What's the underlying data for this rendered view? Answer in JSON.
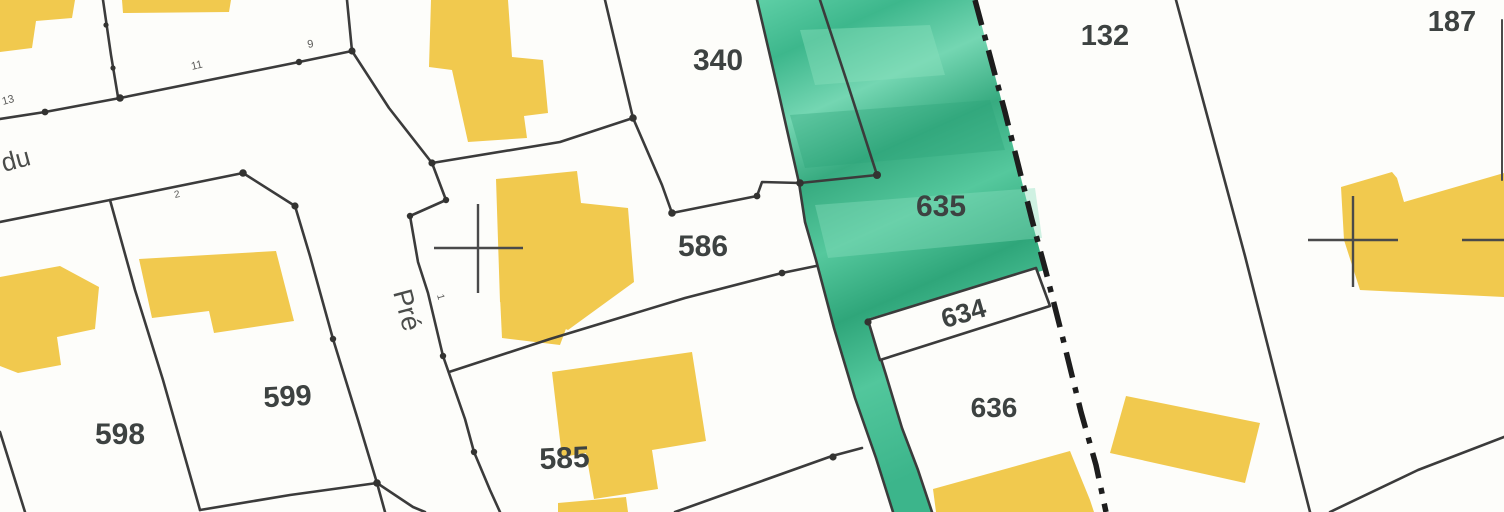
{
  "map": {
    "kind": "cadastral-parcel-map",
    "street": {
      "word_du": "du",
      "word_pre": "Pré"
    },
    "highlighted_parcel": "635",
    "parcels": [
      {
        "number": "340"
      },
      {
        "number": "586"
      },
      {
        "number": "635"
      },
      {
        "number": "634"
      },
      {
        "number": "636"
      },
      {
        "number": "132"
      },
      {
        "number": "187"
      },
      {
        "number": "598"
      },
      {
        "number": "599"
      },
      {
        "number": "585"
      }
    ],
    "survey_marks": [
      {
        "value": "13"
      },
      {
        "value": "11"
      },
      {
        "value": "9"
      },
      {
        "value": "2"
      },
      {
        "value": "1"
      }
    ],
    "colors": {
      "background": "#fdfdfa",
      "building_fill": "#f1c94e",
      "highlight_green": "#4cc49a",
      "boundary_line": "#3b3b3b",
      "commune_boundary": "#1d1d1d",
      "parcel_label": "#3d4241",
      "highlight_label": "#2a5a47"
    }
  }
}
